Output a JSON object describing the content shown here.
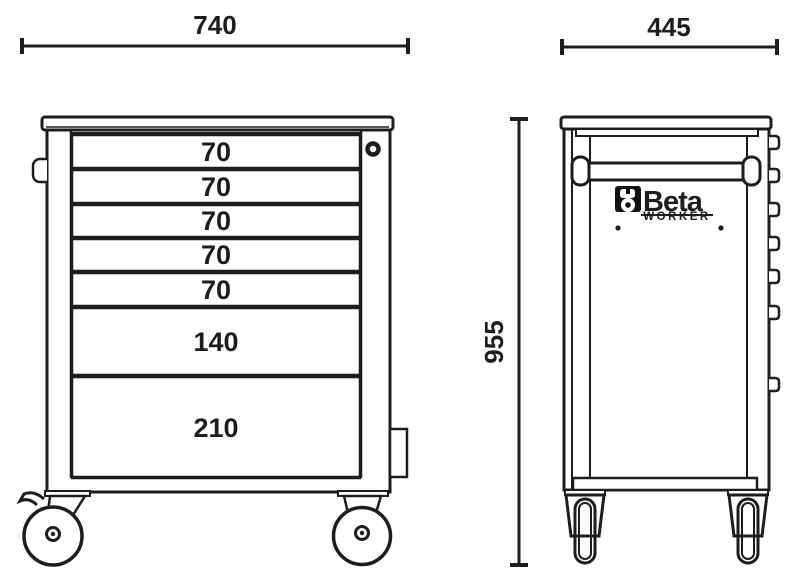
{
  "dimensions": {
    "front_width": "740",
    "side_depth": "445",
    "height": "955"
  },
  "front_view": {
    "drawer_heights": [
      "70",
      "70",
      "70",
      "70",
      "70",
      "140",
      "210"
    ]
  },
  "side_view": {
    "logo": {
      "brand": "Beta",
      "series": "WORKER"
    }
  },
  "colors": {
    "line": "#1d1d1d",
    "background": "#ffffff",
    "logo_black": "#111111"
  }
}
